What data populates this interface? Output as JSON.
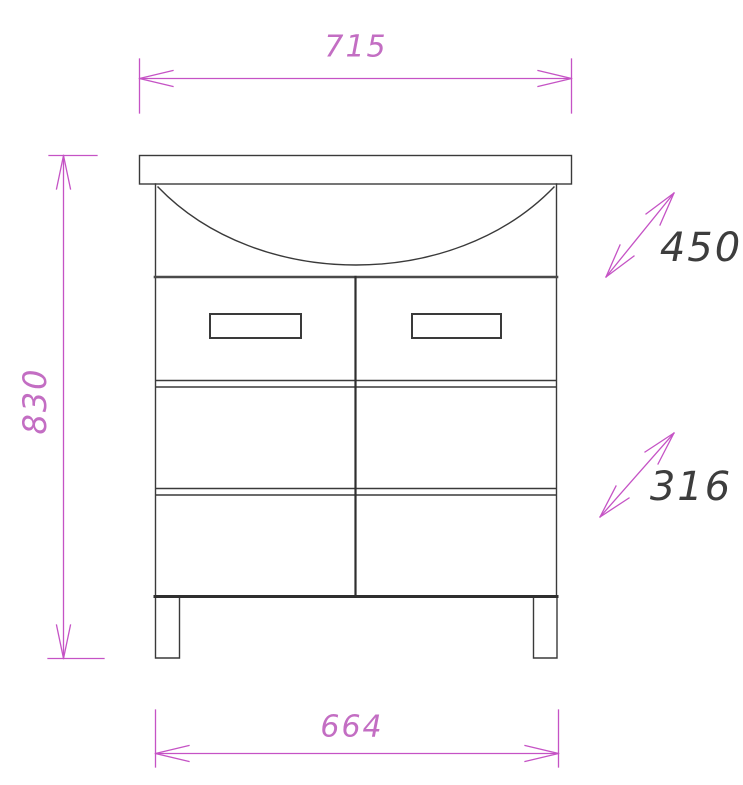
{
  "page": {
    "type": "technical-drawing",
    "subject": "bathroom vanity cabinet with sink, front elevation",
    "background": "#ffffff"
  },
  "colors": {
    "outline": "#333333",
    "dimension_line": "#c553c5",
    "dimension_text_magenta": "#c36ec3",
    "dimension_text_dark": "#3d3d3d"
  },
  "dimensions": {
    "top_width": {
      "value": "715"
    },
    "left_height": {
      "value": "830"
    },
    "right_upper": {
      "value": "450"
    },
    "right_lower": {
      "value": "316"
    },
    "bottom_width": {
      "value": "664"
    }
  }
}
